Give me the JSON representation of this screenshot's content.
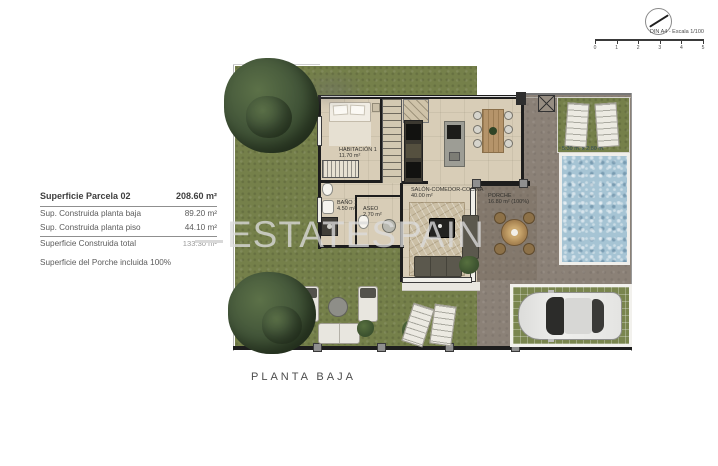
{
  "sheet": {
    "scale_label": "DIN A4 - Escala 1/100",
    "scale_ticks": [
      "0",
      "1",
      "2",
      "3",
      "4",
      "5"
    ]
  },
  "surface_table": {
    "header": {
      "label": "Superficie Parcela 02",
      "value": "208.60 m²"
    },
    "rows": [
      {
        "label": "Sup. Construida planta baja",
        "value": "89.20 m²"
      },
      {
        "label": "Sup. Construida planta piso",
        "value": "44.10 m²"
      }
    ],
    "total": {
      "label": "Superficie Construida total",
      "value": "133.30 m²"
    },
    "note": "Superficie del Porche incluida 100%"
  },
  "rooms": [
    {
      "name": "HABITACIÓN 1",
      "area": "11.70 m²"
    },
    {
      "name": "BAÑO 1",
      "area": "4.50 m²"
    },
    {
      "name": "ASEO",
      "area": "2.70 m²"
    },
    {
      "name": "SALÓN-COMEDOR-COCINA",
      "area": "40.00 m²"
    },
    {
      "name": "PORCHE",
      "area": "16.80 m² (100%)"
    }
  ],
  "pool": {
    "dimensions": "5.30 m. x 2.80 m."
  },
  "plan": {
    "title": "PLANTA BAJA"
  },
  "watermark": {
    "text": "ESTATESPAIN"
  },
  "colors": {
    "grass": "#75804a",
    "gravel": "#8b8177",
    "house_floor": "#d8cdb7",
    "pool_water": "#a6c4d4",
    "wall": "#1d1d1d",
    "watermark": "#dbdbdb",
    "text": "#4d4d4d"
  }
}
